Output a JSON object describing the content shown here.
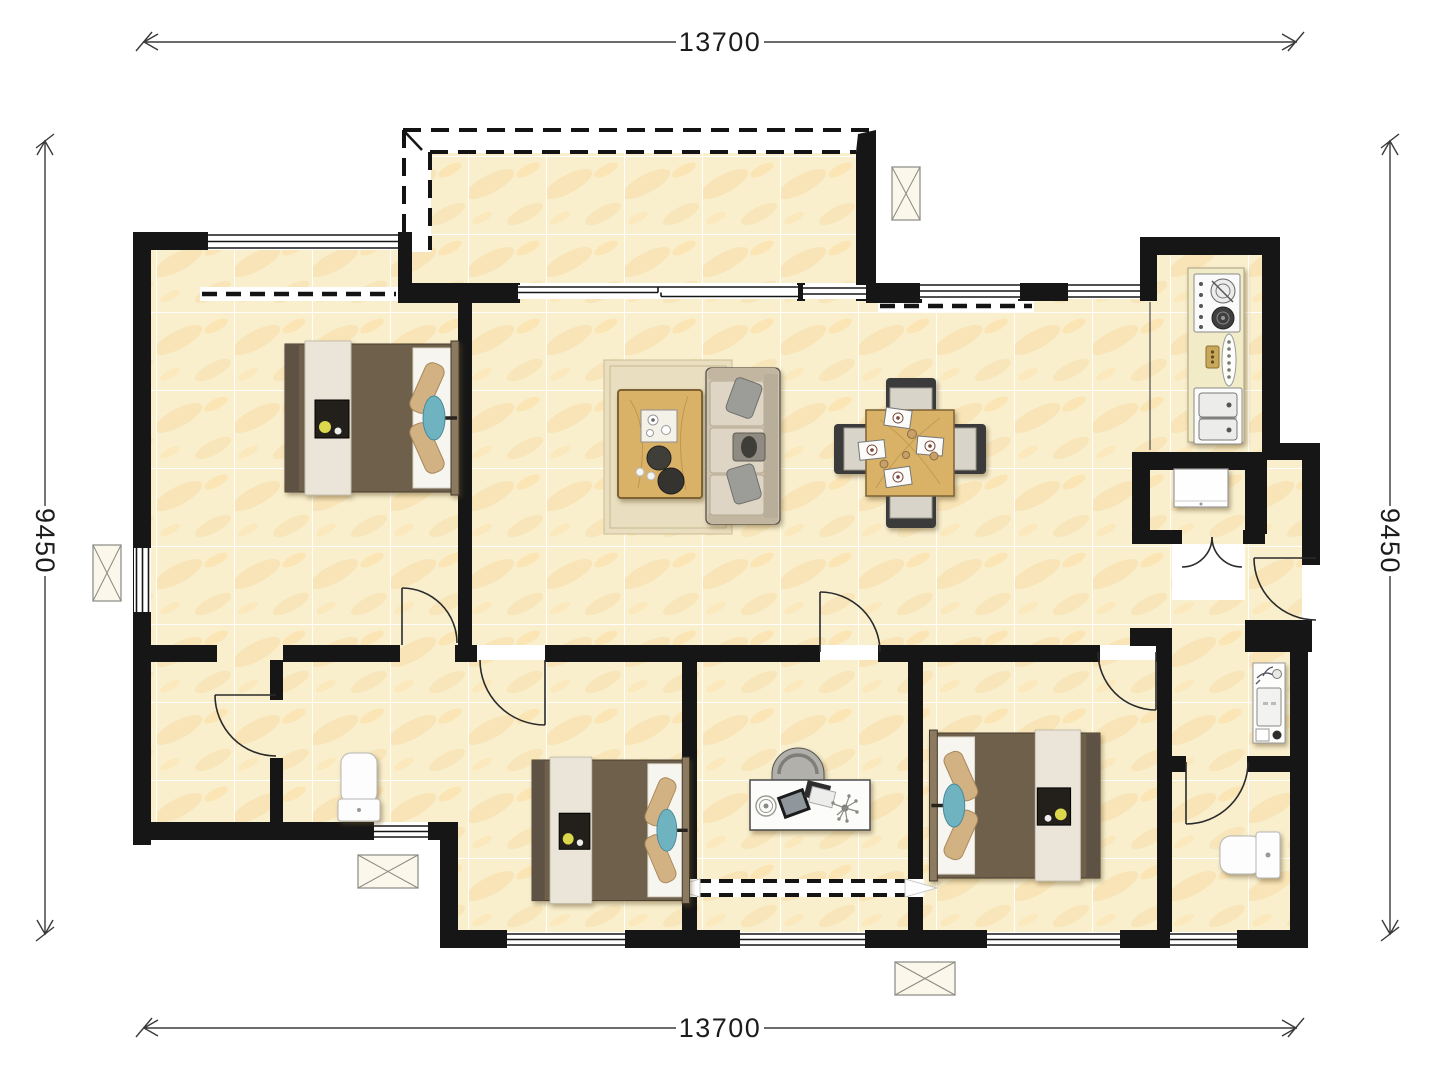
{
  "page": {
    "type": "apartment-floor-plan",
    "background": "#ffffff"
  },
  "dimensions": {
    "top": {
      "label": "13700"
    },
    "bottom": {
      "label": "13700"
    },
    "left": {
      "label": "9450"
    },
    "right": {
      "label": "9450"
    }
  },
  "colors": {
    "wall": "#161616",
    "floor_tile": "#f9efcd",
    "tile_vein": "#f0a93c",
    "grout": "#ffffff",
    "wood": "#d9b267",
    "rug": "#e9debf",
    "sofa": "#cfc4b0",
    "bed_duvet": "#6f604b",
    "bed_runner": "#eae5d8",
    "pillow_tan": "#d2b183",
    "accent_teal": "#6fb3c0",
    "kitchen_counter": "#f1ebc8",
    "fixture_white": "#fdfdfd",
    "dimension_line": "#3a3a3a",
    "dimension_text": "#1c1c1c"
  },
  "icons": [
    "x-shaft-icon",
    "door-swing-icon",
    "window-icon",
    "sliding-window-icon",
    "dashed-opening-icon",
    "double-bed-icon",
    "sofa-icon",
    "coffee-table-icon",
    "dining-table-icon",
    "stove-icon",
    "kitchen-sink-icon",
    "fridge-icon",
    "vanity-sink-icon",
    "toilet-icon",
    "desk-icon",
    "chair-icon"
  ]
}
